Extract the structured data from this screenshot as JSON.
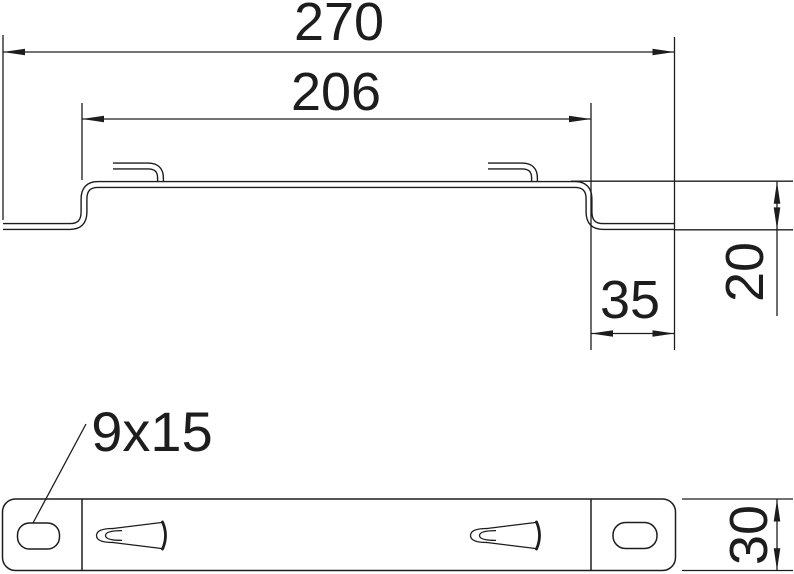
{
  "colors": {
    "line": "#1d1d1d",
    "background": "#ffffff"
  },
  "dims": {
    "overall_width": "270",
    "inner_width": "206",
    "end_section_width": "35",
    "profile_height": "20",
    "rail_width": "30",
    "slot_size": "9x15"
  }
}
